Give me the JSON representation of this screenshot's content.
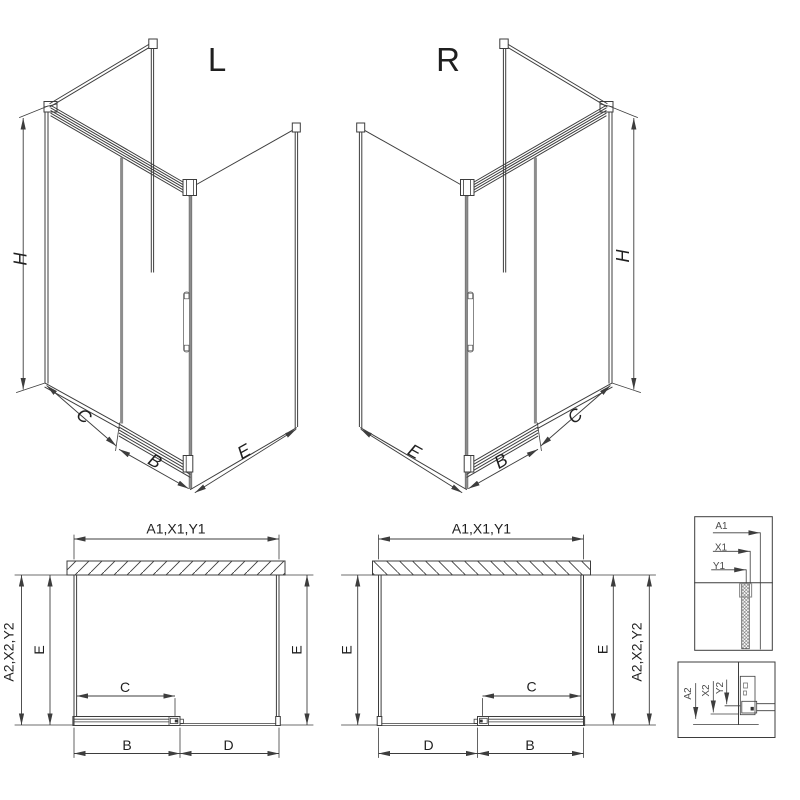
{
  "drawing": {
    "title": "shower-enclosure-technical-drawing",
    "views": {
      "iso_left": {
        "title": "L",
        "height_dim": "H",
        "panel_dim": "C",
        "door_dim": "B",
        "side_dim": "E"
      },
      "iso_right": {
        "title": "R",
        "height_dim": "H",
        "panel_dim": "C",
        "door_dim": "B",
        "side_dim": "E"
      },
      "plan_left": {
        "width_dim": "A1,X1,Y1",
        "depth_outer_dim": "A2,X2,Y2",
        "depth_left_dim": "E",
        "depth_right_dim": "E",
        "door_dim": "C",
        "track_dim": "B",
        "opening_dim": "D"
      },
      "plan_right": {
        "width_dim": "A1,X1,Y1",
        "depth_outer_dim": "A2,X2,Y2",
        "depth_left_dim": "E",
        "depth_right_dim": "E",
        "door_dim": "C",
        "track_dim": "B",
        "opening_dim": "D"
      },
      "detail_top": {
        "dim_1": "A1",
        "dim_2": "X1",
        "dim_3": "Y1"
      },
      "detail_bottom": {
        "dim_1": "A2",
        "dim_2": "X2",
        "dim_3": "Y2"
      }
    },
    "colors": {
      "line": "#3d3d3d",
      "profile_gray": "#8d8d8d",
      "background": "#ffffff"
    }
  }
}
